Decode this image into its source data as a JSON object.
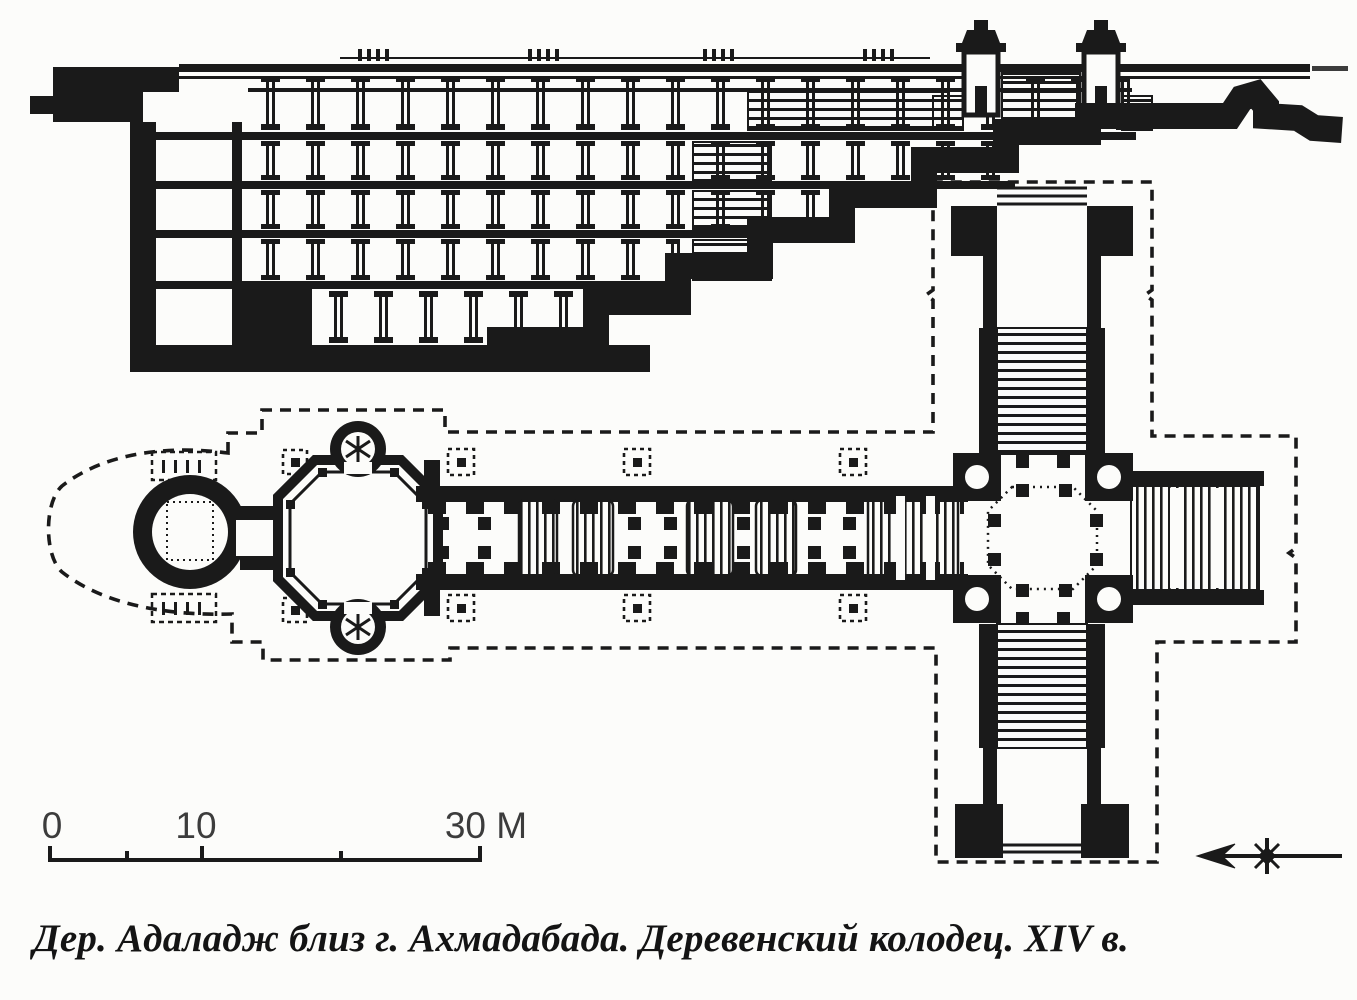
{
  "colors": {
    "ink": "#1a1a1a",
    "paper": "#fcfcfa",
    "label": "#3c3c3c"
  },
  "scale_bar": {
    "labels": [
      "0",
      "10",
      "30 M"
    ],
    "ticks_m": [
      0,
      5,
      10,
      20,
      30
    ]
  },
  "compass": {
    "icon": "north-arrow",
    "points": "left"
  },
  "caption": {
    "text": "Дер. Адаладж близ г. Ахмадабада. Деревенский колодец. XIV в."
  }
}
